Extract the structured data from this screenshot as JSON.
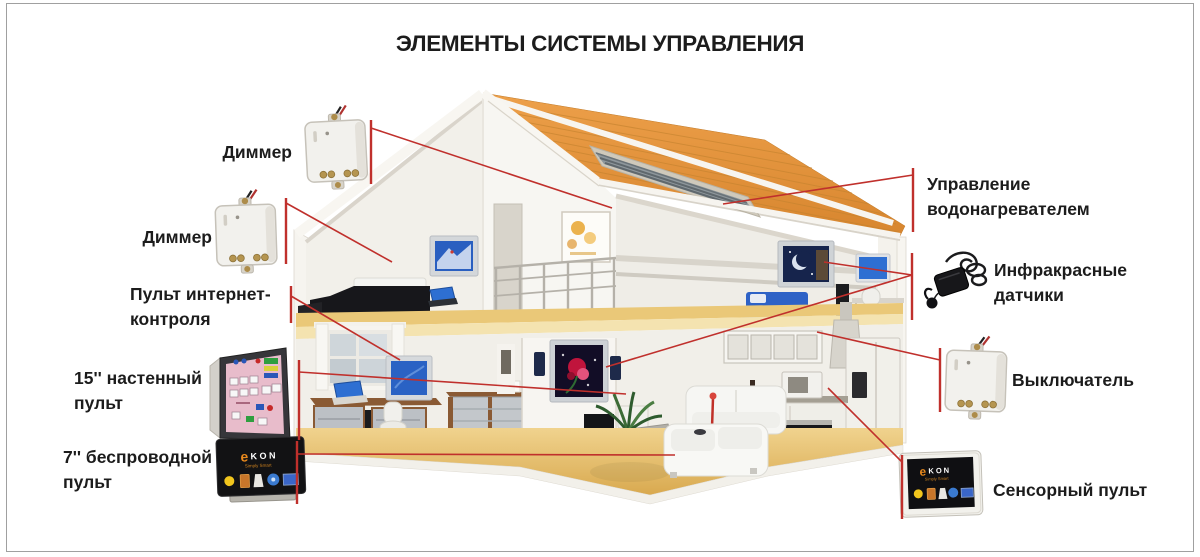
{
  "title": "ЭЛЕМЕНТЫ СИСТЕМЫ УПРАВЛЕНИЯ",
  "labels": {
    "dimmer_top": "Диммер",
    "dimmer_middle": "Диммер",
    "internet_control": {
      "line1": "Пульт интернет-",
      "line2": "контроля"
    },
    "wall_panel_15": {
      "line1": "15'' настенный",
      "line2": "пульт"
    },
    "wireless_panel_7": {
      "line1": "7'' беспроводной",
      "line2": "пульт"
    },
    "water_heater": {
      "line1": "Управление",
      "line2": "водонагревателем"
    },
    "ir_sensors": {
      "line1": "Инфракрасные",
      "line2": "датчики"
    },
    "switch": "Выключатель",
    "touch_panel": "Сенсорный пульт"
  },
  "devices": {
    "ekon_logo_e": "e",
    "ekon_logo_rest": "KON",
    "ekon_tagline": "Simply Smart"
  },
  "icons": [
    "dimmer-module-icon",
    "dimmer-module-icon",
    "wall-panel-icon",
    "wireless-panel-icon",
    "ir-sensor-icon",
    "switch-module-icon",
    "touch-panel-icon"
  ],
  "colors": {
    "connector": "#c0302c",
    "roof": "#e5923a",
    "floor": "#e7c06a",
    "text": "#1c1c1c",
    "border": "#a0a0a0"
  },
  "connectors": {
    "bars": [
      {
        "x": 371,
        "y1": 120,
        "y2": 184
      },
      {
        "x": 286,
        "y1": 198,
        "y2": 264
      },
      {
        "x": 291,
        "y1": 286,
        "y2": 323
      },
      {
        "x": 299,
        "y1": 360,
        "y2": 440
      },
      {
        "x": 297,
        "y1": 441,
        "y2": 504
      },
      {
        "x": 913,
        "y1": 168,
        "y2": 232
      },
      {
        "x": 912,
        "y1": 253,
        "y2": 320
      },
      {
        "x": 940,
        "y1": 348,
        "y2": 412
      },
      {
        "x": 902,
        "y1": 455,
        "y2": 519
      }
    ],
    "lines": [
      {
        "x1": 371,
        "y1": 128,
        "x2": 612,
        "y2": 208
      },
      {
        "x1": 286,
        "y1": 203,
        "x2": 392,
        "y2": 262
      },
      {
        "x1": 291,
        "y1": 296,
        "x2": 400,
        "y2": 360
      },
      {
        "x1": 299,
        "y1": 372,
        "x2": 626,
        "y2": 394
      },
      {
        "x1": 297,
        "y1": 454,
        "x2": 675,
        "y2": 455
      },
      {
        "x1": 913,
        "y1": 175,
        "x2": 723,
        "y2": 204
      },
      {
        "x1": 912,
        "y1": 275,
        "x2": 824,
        "y2": 262
      },
      {
        "x1": 912,
        "y1": 275,
        "x2": 606,
        "y2": 367
      },
      {
        "x1": 940,
        "y1": 360,
        "x2": 817,
        "y2": 332
      },
      {
        "x1": 902,
        "y1": 462,
        "x2": 828,
        "y2": 388
      }
    ]
  }
}
